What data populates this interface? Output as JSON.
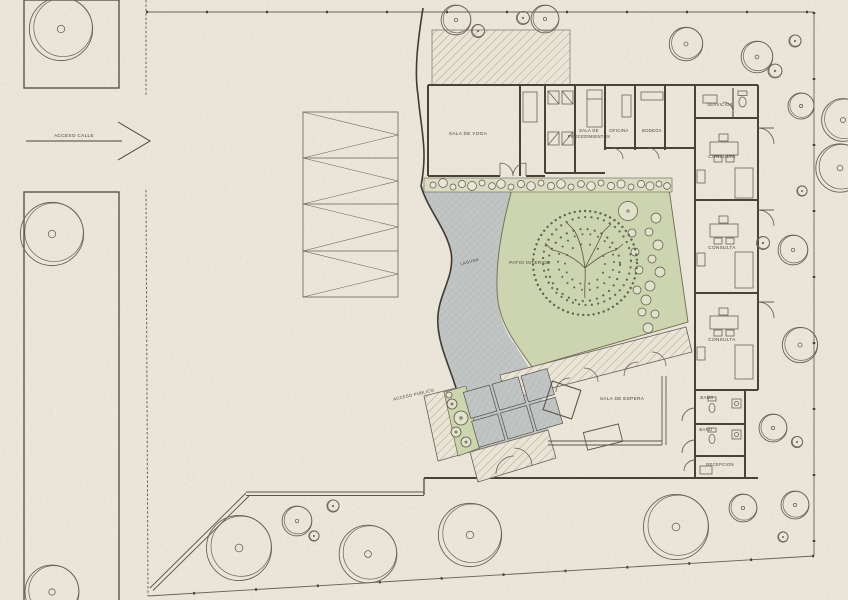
{
  "plan": {
    "site": {
      "acceso_calle": "ACCESO CALLE",
      "acceso_publico": "ACCESO PUBLICO"
    },
    "rooms": {
      "sala_de_yoga": "SALA DE YOGA",
      "sala_de_procedimientos_line1": "SALA DE",
      "sala_de_procedimientos_line2": "PROCEDIMIENTOS",
      "oficina": "OFICINA",
      "bodega": "BODEGA",
      "servicios": "SERVICIOS",
      "consulta_1": "CONSULTA",
      "consulta_2": "CONSULTA",
      "consulta_3": "CONSULTA",
      "bano_1": "BAÑO",
      "bano_2": "BAÑO",
      "recepcion": "RECEPCION",
      "sala_de_espera": "SALA DE ESPERA"
    },
    "landscape": {
      "patio_interior": "PATIO INTERIOR",
      "laguna": "LAGUNA"
    },
    "colors": {
      "paper": "#ece6da",
      "ink": "#4a4238",
      "patio_green": "#cdd5b0",
      "planting_strip": "#d9dcc0",
      "water_gray": "#c1c6c5",
      "paver_gray": "#b6bdc2"
    }
  }
}
